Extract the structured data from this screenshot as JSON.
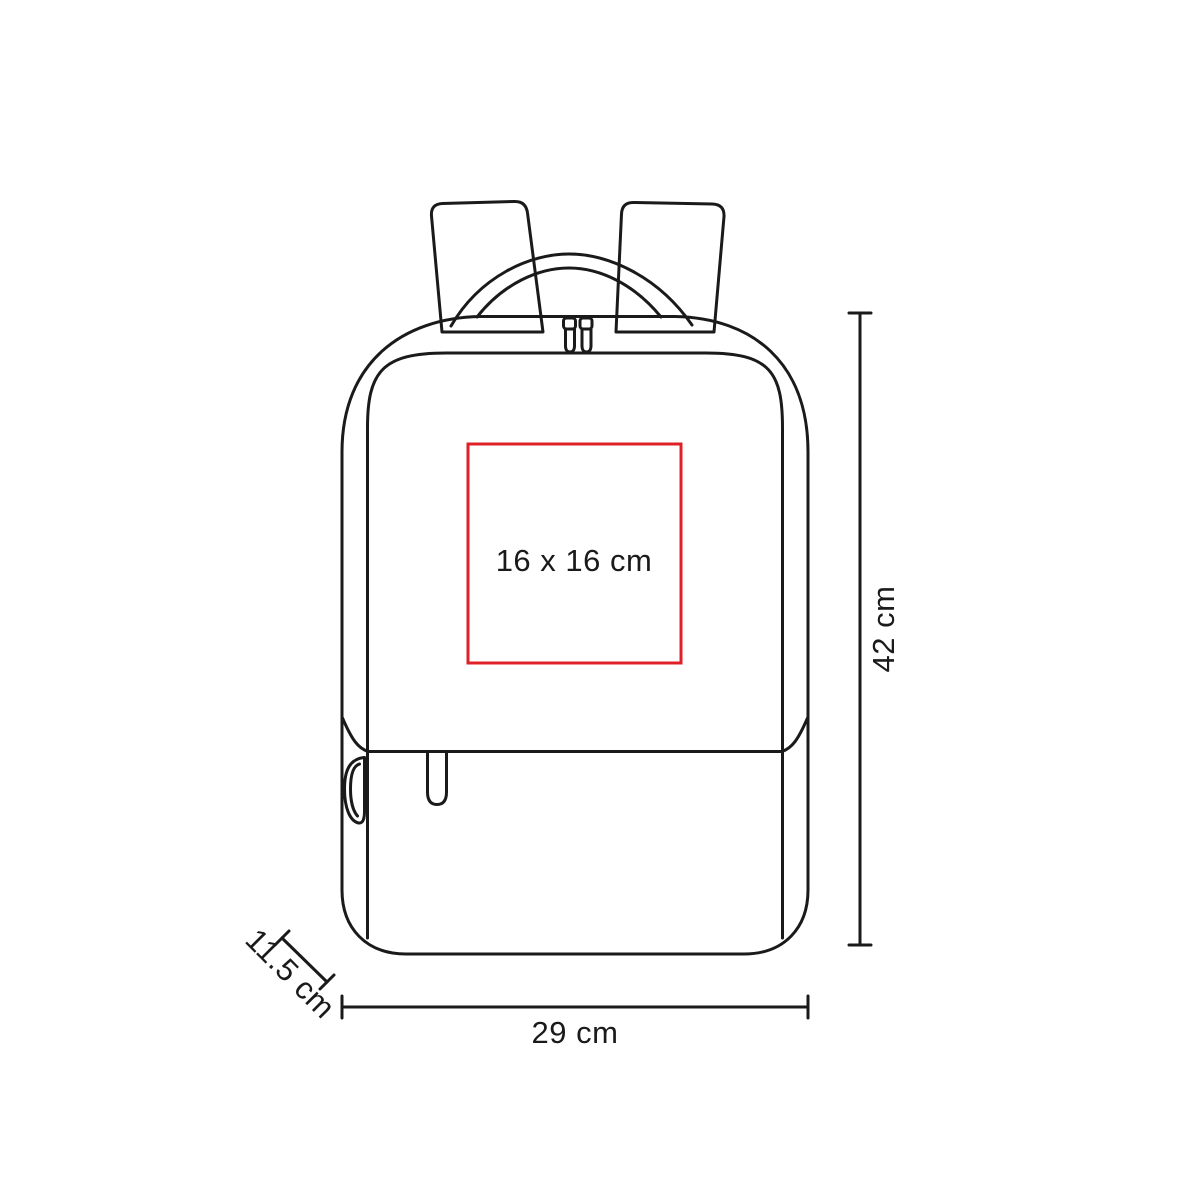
{
  "diagram": {
    "product": "backpack-dimension-diagram",
    "line_color": "#1a1a1a",
    "background": "#ffffff"
  },
  "imprint_area": {
    "label": "16 x 16 cm",
    "border_color": "#df2127"
  },
  "dimensions": {
    "height": {
      "label": "42 cm"
    },
    "width": {
      "label": "29 cm"
    },
    "depth": {
      "label": "11.5 cm"
    }
  }
}
